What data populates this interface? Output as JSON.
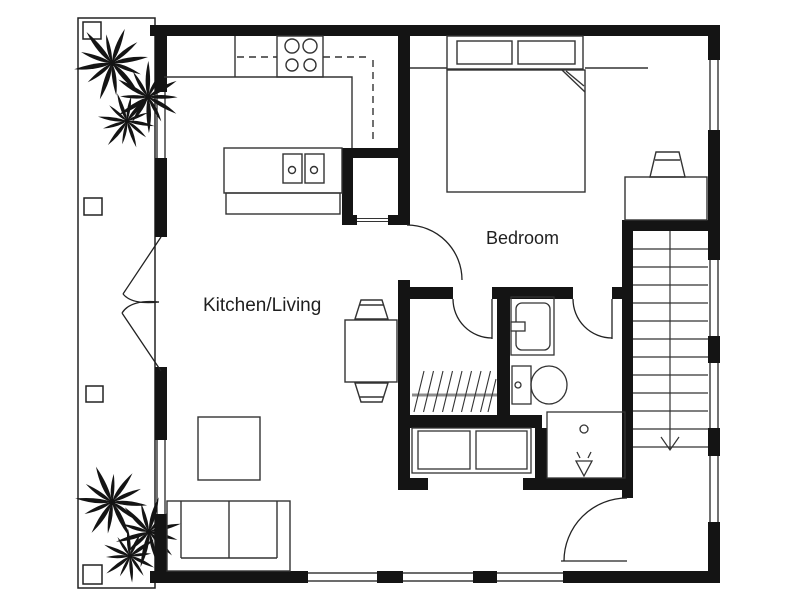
{
  "labels": {
    "kitchen_living": "Kitchen/Living",
    "bedroom": "Bedroom"
  },
  "colors": {
    "background": "#ffffff",
    "wall": "#141414",
    "furniture_line": "#333333",
    "closet_rod": "#8c8c8c",
    "text": "#1f1f1f"
  },
  "fixtures": [
    "palm-plant",
    "stove-burners",
    "island-sink",
    "dining-table",
    "sofa",
    "coffee-table",
    "double-bed",
    "desk",
    "stairs-down-arrow",
    "wardrobe-rail",
    "washer-dryer",
    "toilet",
    "sink-vanity",
    "shower"
  ]
}
